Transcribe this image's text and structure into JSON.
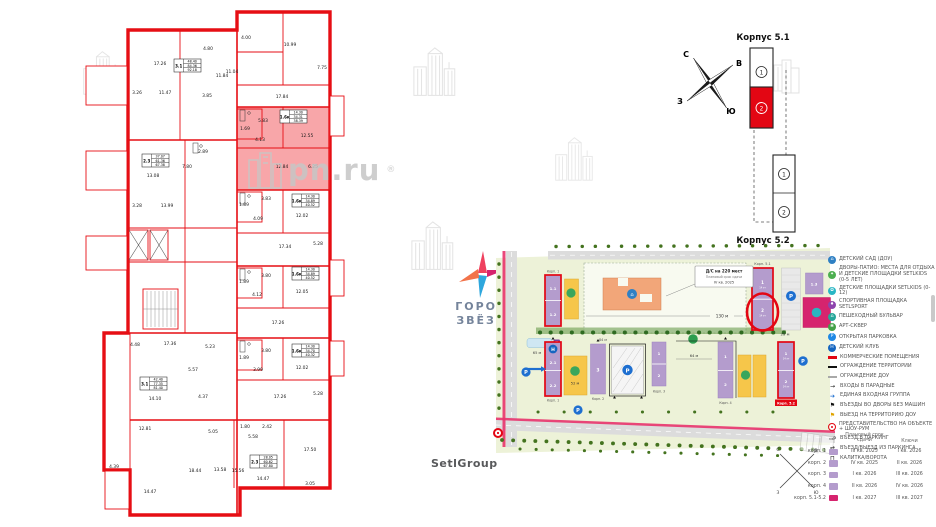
{
  "watermark": {
    "text": "pn.ru",
    "reg": "®"
  },
  "brand": {
    "line1": "ГОРОД",
    "line2": "ЗВЁЗД"
  },
  "developer": {
    "name": "SetlGroup"
  },
  "compass": {
    "n": "С",
    "e": "В",
    "w": "З",
    "s": "Ю"
  },
  "schematic": {
    "title_top": "Корпус 5.1",
    "title_bottom": "Корпус 5.2",
    "b51_s1": "1",
    "b51_s2": "2",
    "b52_s1": "1",
    "b52_s2": "2"
  },
  "siteplan": {
    "callout": {
      "line1": "Д/С на 220 мест",
      "line2": "Плановый срок сдачи",
      "line3": "IV кв. 2025"
    },
    "labels": {
      "k51": "Корп. 5.1",
      "k52": "Корп. 5.2",
      "k1_top": "Корп. 1",
      "k1_bottom": "Корп. 1",
      "k2": "Корп. 2",
      "k3": "Корп. 3",
      "k4": "Корп. 4"
    },
    "sections": {
      "tl1": "1.1",
      "tl2": "1.2",
      "tr": "1.3",
      "bl1": "2.1",
      "bl2": "2.2",
      "k2s": "3",
      "k3s1": "1",
      "k3s2": "2",
      "k4s1": "1",
      "k4s2": "2",
      "b51s1": "1",
      "b51s2": "2",
      "b52s1": "1",
      "b52s2": "2",
      "floors": "14 эт"
    },
    "dims": {
      "d130": "130 м",
      "d25": "25 м",
      "d65": "65 м",
      "d52": "52 м",
      "d64": "64 м",
      "d84": "84 м"
    },
    "icons": {
      "p": "P",
      "h": "Н",
      "t": "Т",
      "home": "⌂"
    },
    "accent_red": "#e30613",
    "purple": "#b49ccd",
    "magenta": "#d6246e",
    "yellow": "#f6c64a",
    "orange": "#f2a679",
    "green_bg": "#edf2d8"
  },
  "legend": {
    "items": [
      {
        "label": "ДЕТСКИЙ САД (ДОУ)"
      },
      {
        "label": "ДВОРЫ-ПАТИО: МЕСТА ДЛЯ ОТДЫХА И ДЕТСКИЕ ПЛОЩАДКИ SETLKIDS (0-5 ЛЕТ)"
      },
      {
        "label": "ДЕТСКИЕ ПЛОЩАДКИ SETLKIDS (0-12)"
      },
      {
        "label": "СПОРТИВНАЯ ПЛОЩАДКА SETLSPORT"
      },
      {
        "label": "ПЕШЕХОДНЫЙ БУЛЬВАР"
      },
      {
        "label": "АРТ-СКВЕР"
      },
      {
        "label": "ОТКРЫТАЯ ПАРКОВКА"
      },
      {
        "label": "ДЕТСКИЙ КЛУБ"
      },
      {
        "label": "КОММЕРЧЕСКИЕ ПОМЕЩЕНИЯ"
      },
      {
        "label": "ОГРАЖДЕНИЕ ТЕРРИТОРИИ"
      },
      {
        "label": "ОГРАЖДЕНИЕ ДОУ"
      },
      {
        "label": "ВХОДЫ В ПАРАДНЫЕ"
      },
      {
        "label": "ЕДИНАЯ ВХОДНАЯ ГРУППА"
      },
      {
        "label": "ВЪЕЗДЫ ВО ДВОРЫ БЕЗ МАШИН"
      },
      {
        "label": "ВЫЕЗД НА ТЕРРИТОРИЮ ДОУ"
      },
      {
        "label": "ПРЕДСТАВИТЕЛЬСТВО НА ОБЪЕКТЕ + ШОУ-РУМ"
      },
      {
        "label": "ВЪЕЗД В ПАРКИНГ"
      },
      {
        "label": "ВЪЕЗД/ВЫЕЗД ИЗ ПАРКИНГА"
      },
      {
        "label": "КАЛИТКА/ВОРОТА"
      }
    ]
  },
  "handover": {
    "header_term": "Плановый срок сдачи",
    "header_keys": "Ключи",
    "rows": [
      {
        "name": "корп. 1",
        "term": "III кв. 2025",
        "keys": "I кв. 2026"
      },
      {
        "name": "корп. 2",
        "term": "IV кв. 2025",
        "keys": "II кв. 2026"
      },
      {
        "name": "корп. 3",
        "term": "I кв. 2026",
        "keys": "III кв. 2026"
      },
      {
        "name": "корп. 4",
        "term": "II кв. 2026",
        "keys": "IV кв. 2026"
      },
      {
        "name": "корп. 5.1-5.2",
        "term": "I кв. 2027",
        "keys": "III кв. 2027"
      }
    ],
    "swatch_purple": "#b49ccd",
    "swatch_magenta": "#d6246e"
  },
  "floorplan": {
    "units": [
      {
        "type": "3.1",
        "v": [
          "48.40",
          "84.36",
          "92.18"
        ]
      },
      {
        "type": "2.3",
        "v": [
          "37.07",
          "61.36",
          "67.38"
        ]
      },
      {
        "type": "1.6к",
        "v": [
          "14.30",
          "34.31",
          "38.39"
        ]
      },
      {
        "type": "1.6к",
        "v": [
          "14.30",
          "34.89",
          "40.52"
        ]
      },
      {
        "type": "1.6к",
        "v": [
          "14.30",
          "34.89",
          "40.52"
        ]
      },
      {
        "type": "1.6к",
        "v": [
          "14.30",
          "34.70",
          "40.32"
        ]
      },
      {
        "type": "3.1",
        "v": [
          "42.40",
          "77.35",
          "81.40"
        ]
      },
      {
        "type": "2.3",
        "v": [
          "28.05",
          "60.62",
          "67.80"
        ]
      }
    ],
    "areas": [
      "17.26",
      "4.80",
      "11.84",
      "11.47",
      "3.26",
      "3.85",
      "4.00",
      "10.99",
      "7.75",
      "11.04",
      "17.84",
      "5.83",
      "1.69",
      "4.13",
      "12.55",
      "12.84",
      "6.25",
      "13.08",
      "7.80",
      "2.89",
      "3.28",
      "13.99",
      "3.83",
      "1.89",
      "4.09",
      "12.02",
      "17.34",
      "5.28",
      "3.80",
      "1.89",
      "4.12",
      "12.05",
      "17.26",
      "3.80",
      "1.89",
      "3.99",
      "12.02",
      "17.26",
      "5.28",
      "4.48",
      "17.36",
      "5.23",
      "5.57",
      "14.10",
      "4.37",
      "12.81",
      "5.05",
      "1.80",
      "2.42",
      "5.58",
      "17.50",
      "13.58",
      "14.47",
      "3.05",
      "18.44",
      "15.56",
      "14.47",
      "4.39"
    ]
  }
}
